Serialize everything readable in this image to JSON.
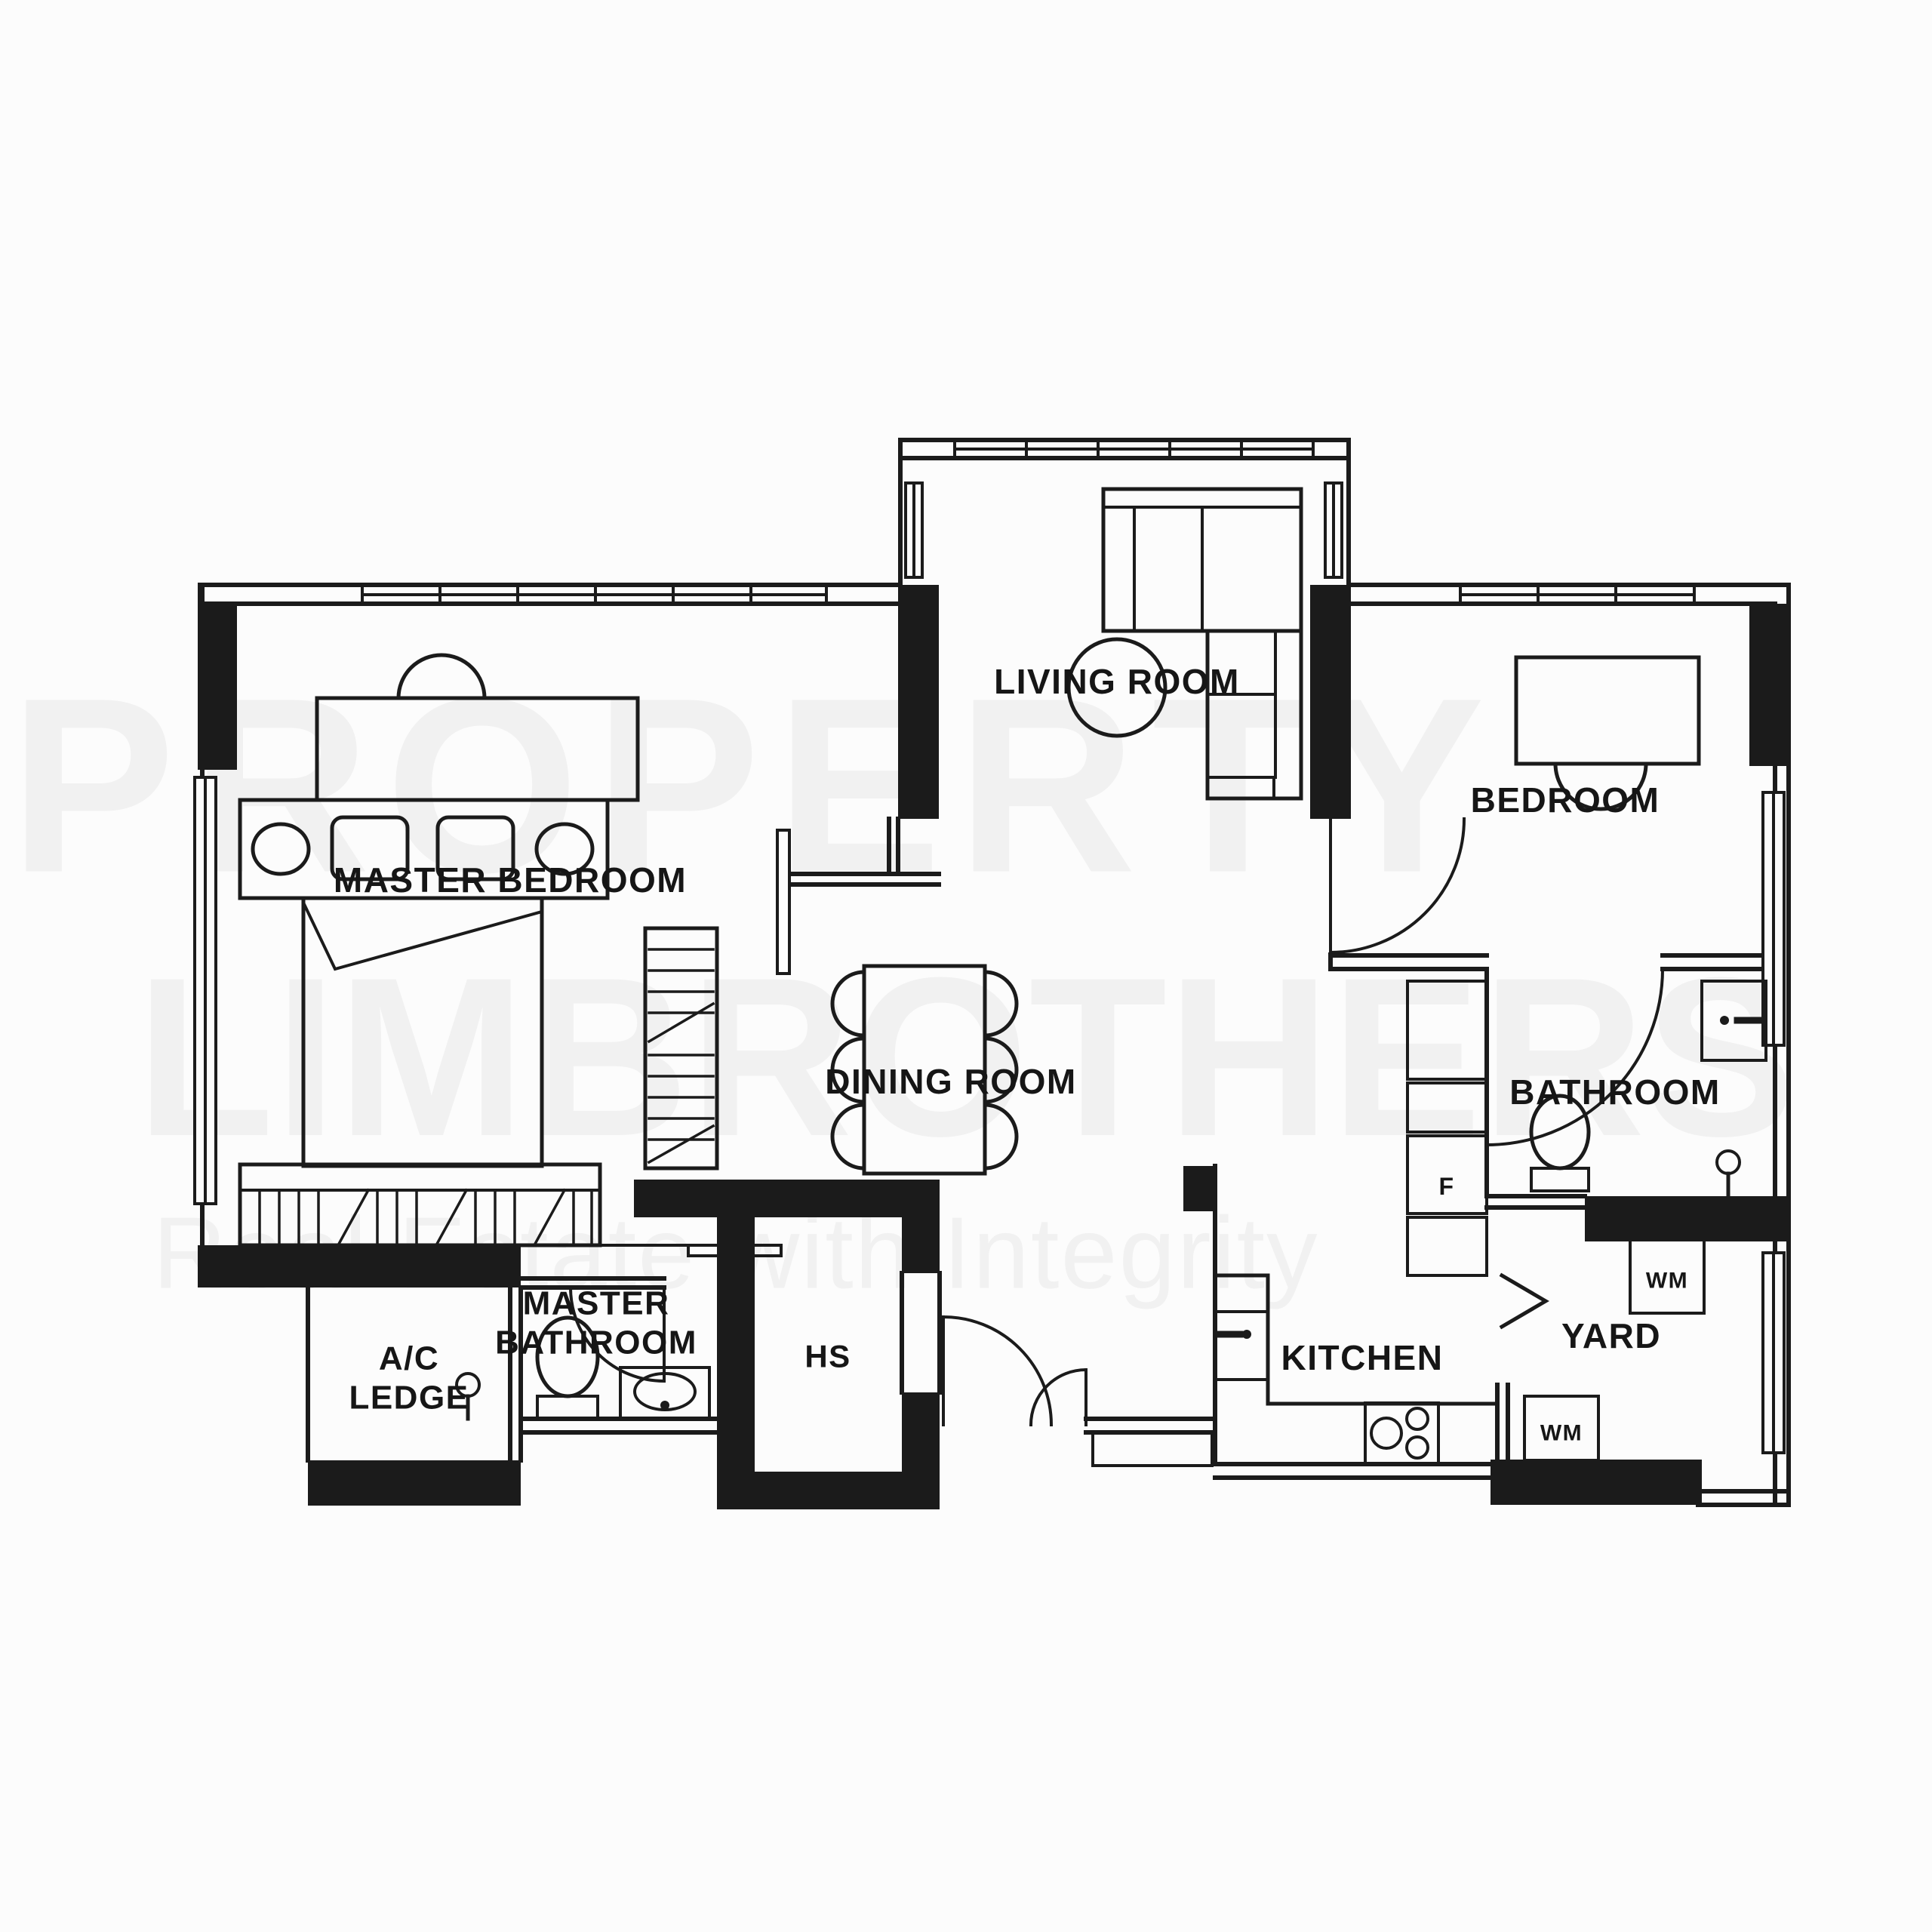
{
  "canvas": {
    "bg": "#fcfcfc",
    "line_color": "#1b1b1b",
    "label_color": "#161616",
    "watermark_color": "#f1f1f1"
  },
  "watermark": {
    "line1": "PROPERTY",
    "line2": "LIMBROTHERS",
    "line3": "Real Estate with Integrity"
  },
  "rooms": {
    "master_bedroom": {
      "label": "MASTER BEDROOM"
    },
    "living_room": {
      "label": "LIVING ROOM"
    },
    "bedroom": {
      "label": "BEDROOM"
    },
    "dining_room": {
      "label": "DINING ROOM"
    },
    "bathroom": {
      "label": "BATHROOM"
    },
    "master_bathroom": {
      "label_line1": "MASTER",
      "label_line2": "BATHROOM"
    },
    "ac_ledge": {
      "label_line1": "A/C",
      "label_line2": "LEDGE"
    },
    "household_shelter": {
      "label": "HS"
    },
    "kitchen": {
      "label": "KITCHEN"
    },
    "yard": {
      "label": "YARD"
    }
  },
  "appliances": {
    "fridge": "F",
    "washer_top": "WM",
    "washer_bottom": "WM"
  }
}
